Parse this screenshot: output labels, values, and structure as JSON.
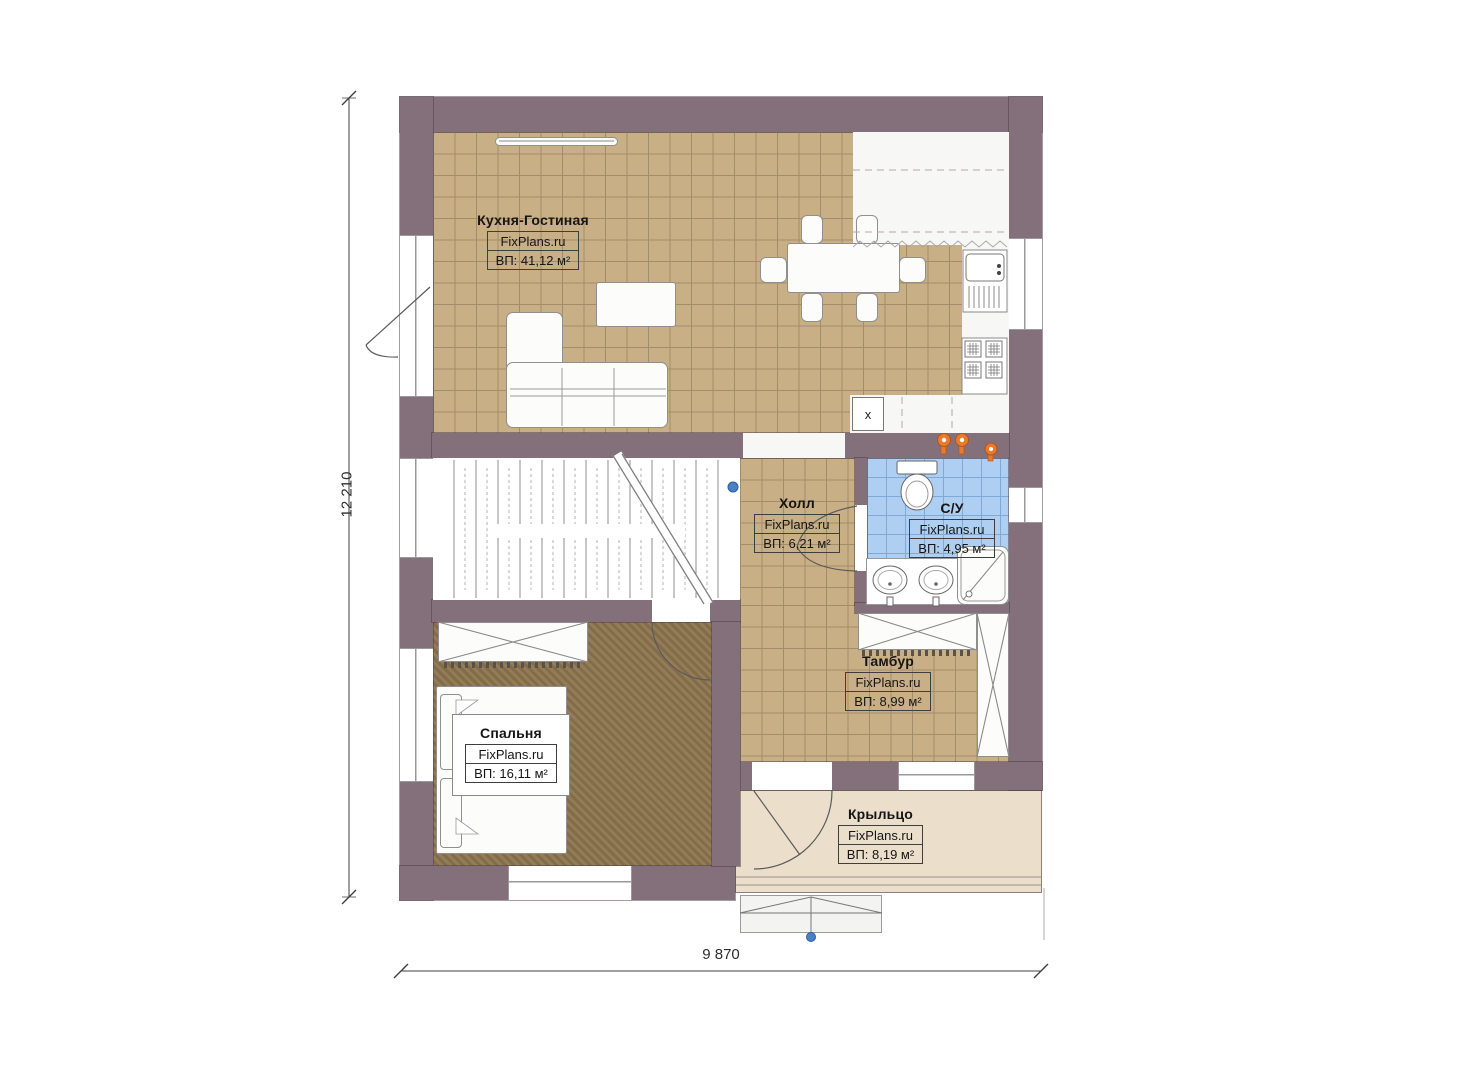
{
  "plan": {
    "dimension_height_label": "12 210",
    "dimension_width_label": "9 870",
    "rooms": [
      {
        "name": "Кухня-Гостиная",
        "brand": "FixPlans.ru",
        "area": "ВП: 41,12 м²"
      },
      {
        "name": "Холл",
        "brand": "FixPlans.ru",
        "area": "ВП: 6,21 м²"
      },
      {
        "name": "С/У",
        "brand": "FixPlans.ru",
        "area": "ВП: 4,95 м²"
      },
      {
        "name": "Тамбур",
        "brand": "FixPlans.ru",
        "area": "ВП: 8,99 м²"
      },
      {
        "name": "Спальня",
        "brand": "FixPlans.ru",
        "area": "ВП: 16,11 м²"
      },
      {
        "name": "Крыльцо",
        "brand": "FixPlans.ru",
        "area": "ВП: 8,19 м²"
      }
    ],
    "marks": {
      "appliance_mark": "x"
    },
    "colors": {
      "wall": "#84707a",
      "tile_floor": "#c9af85",
      "tile_line": "#a18d6b",
      "bathroom_tile": "#aecff2",
      "bedroom_floor": "#8d744f",
      "porch_floor": "#ebdfcc",
      "accent_orange": "#e87a2e",
      "marker_blue": "#4a80c4"
    }
  }
}
